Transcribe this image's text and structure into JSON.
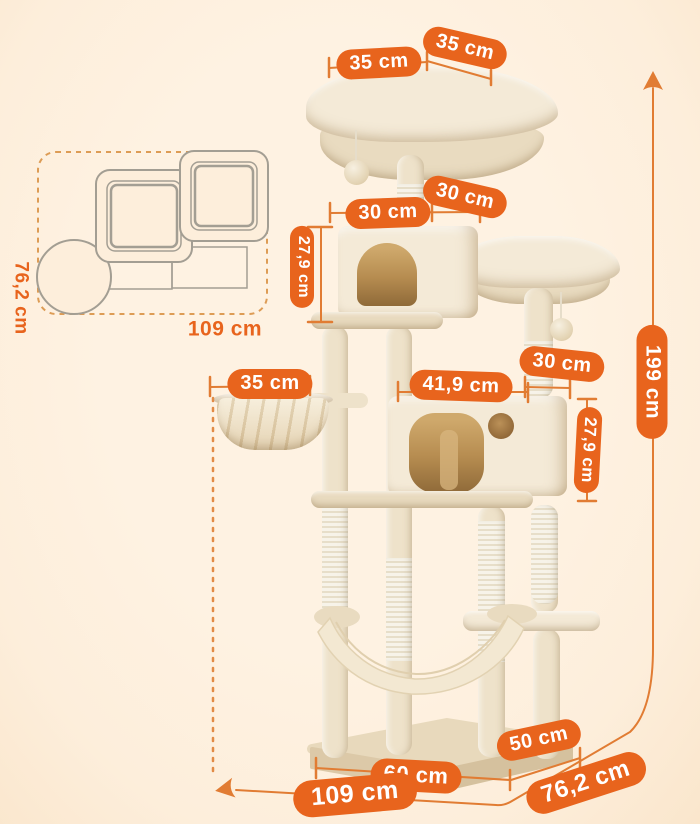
{
  "colors": {
    "background": "#fdeedb",
    "pill": "#e8641d",
    "pill-text": "#ffffff",
    "line": "#e17c33",
    "dash": "#e28b45",
    "sketch": "#a39e93",
    "inset-dash": "#dd9c55",
    "plush": "#f4ead7",
    "plush-dark": "#e9dbc0",
    "post": "#eee2ca",
    "sisal": "#f7f3e9",
    "sisal-stripe": "#e7dec9",
    "open-light": "#cfa96c",
    "open-dark": "#8f6a39",
    "base-top": "#e8d9bc",
    "base-front": "#dcc9a8",
    "base-side": "#d5c19e"
  },
  "dimensions": {
    "top_perch_width": "35 cm",
    "top_perch_depth": "35 cm",
    "upper_condo_depth": "30 cm",
    "upper_condo_width": "30 cm",
    "upper_condo_height": "27,9 cm",
    "middle_perch_width": "30 cm",
    "basket_width": "35 cm",
    "lower_condo_width": "41,9 cm",
    "lower_condo_height": "27,9 cm",
    "total_height": "199 cm",
    "base_depth": "50 cm",
    "base_width": "60 cm",
    "footprint_width": "109 cm",
    "footprint_depth": "76,2 cm"
  },
  "inset": {
    "footprint_width": "109 cm",
    "footprint_depth": "76,2 cm"
  }
}
